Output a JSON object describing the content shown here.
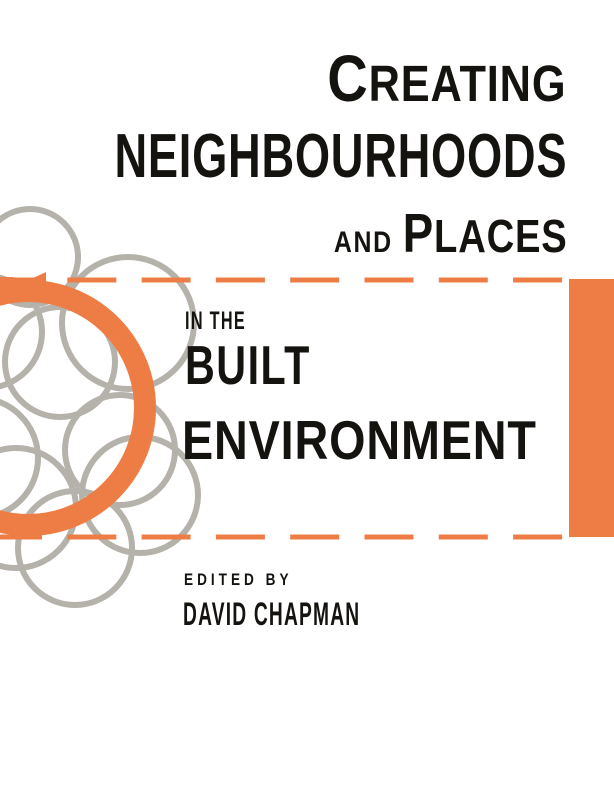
{
  "cover": {
    "title": {
      "line1": "CREATING",
      "line2": "NEIGHBOURHOODS",
      "line3_small": "AND",
      "line3_big": "PLACES",
      "line4_small": "IN THE",
      "line5": "BUILT",
      "line6": "ENVIRONMENT"
    },
    "credits": {
      "edited_by": "EDITED BY",
      "editor_name": "DAVID CHAPMAN"
    },
    "colors": {
      "accent_orange": "#ED7D45",
      "circle_gray": "#B4B2AA",
      "text_black": "#15130F",
      "background": "#FFFFFF"
    },
    "graphics": {
      "motif": "overlapping gray circles with orange circular arrow pointing left",
      "dashed_band": "horizontal orange dashed lines joined by solid orange bar on right edge"
    }
  }
}
